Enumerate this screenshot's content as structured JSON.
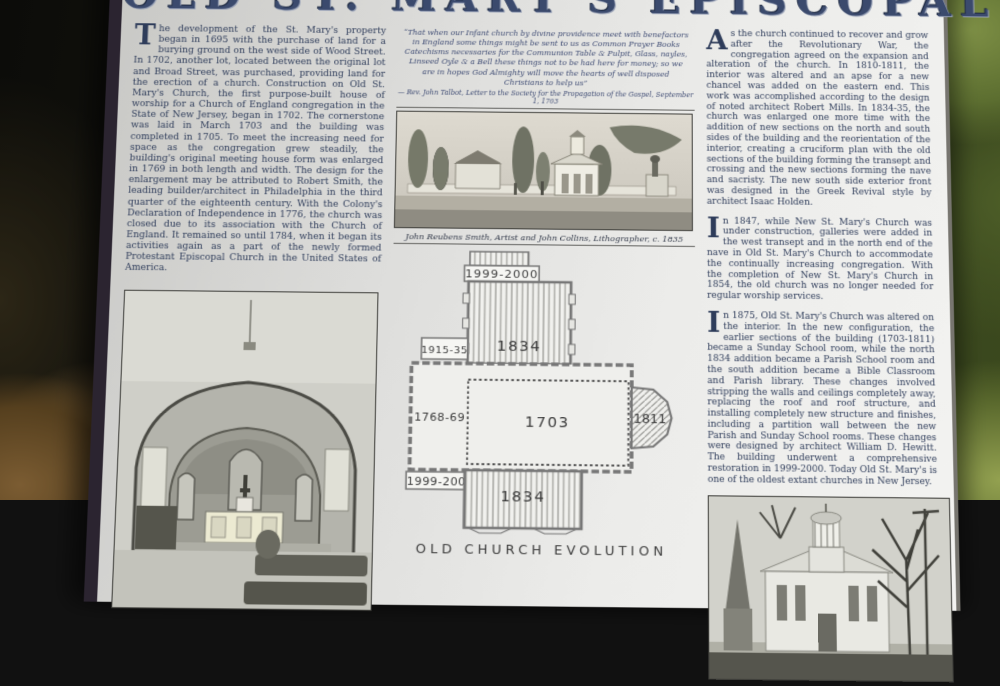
{
  "sign": {
    "title": "OLD ST. MARY'S EPISCOPAL CHURCH",
    "left_column": {
      "paragraph": "The development of the St. Mary's property began in 1695 with the purchase of land for a burying ground on the west side of Wood Street. In 1702, another lot, located between the original lot and Broad Street, was purchased, providing land for the erection of a church. Construction on Old St. Mary's Church, the first purpose-built house of worship for a Church of England congregation in the State of New Jersey, began in 1702. The cornerstone was laid in March 1703 and the building was completed in 1705. To meet the increasing need for space as the congregation grew steadily, the building's original meeting house form was enlarged in 1769 in both length and width. The design for the enlargement may be attributed to Robert Smith, the leading builder/architect in Philadelphia in the third quarter of the eighteenth century. With the Colony's Declaration of Independence in 1776, the church was closed due to its association with the Church of England. It remained so until 1784, when it began its activities again as a part of the newly formed Protestant Episcopal Church in the United States of America."
    },
    "center_column": {
      "quote": "“That when our Infant church by divine providence meet with benefactors in England some things might be sent to us as Common Prayer Books Catechisms necessaries for the Communion Table & Pulpit, Glass, nayles, Linseed Oyle & a Bell these things not to be had here for money; so we are in hopes God Almighty will move the hearts of well disposed Christians to help us”",
      "quote_attribution": "— Rev. John Talbot, Letter to the Society for the Propagation of the Gospel, September 1, 1703",
      "lithograph_caption": "John Reubens Smith, Artist and John Collins, Lithographer, c. 1835",
      "plan": {
        "caption": "OLD CHURCH EVOLUTION",
        "labels": {
          "north_porch": "1999-2000",
          "north_transept": "1834",
          "west_annex": "1915-35",
          "west_extension": "1768-69",
          "original_church": "1703",
          "east_apse": "1811",
          "south_porch": "1999-2000",
          "south_transept": "1834"
        }
      }
    },
    "right_column": {
      "paragraphs": [
        "As the church continued to recover and grow after the Revolutionary War, the congregation agreed on the expansion and alteration of the church. In 1810-1811, the interior was altered and an apse for a new chancel was added on the eastern end. This work was accomplished according to the design of noted architect Robert Mills. In 1834-35, the church was enlarged one more time with the addition of new sections on the north and south sides of the building and the reorientation of the interior, creating a cruciform plan with the old sections of the building forming the transept and crossing and the new sections forming the nave and sacristy. The new south side exterior front was designed in the Greek Revival style by architect Isaac Holden.",
        "In 1847, while New St. Mary's Church was under construction, galleries were added in the west transept and in the north end of the nave in Old St. Mary's Church to accommodate the continually increasing congregation. With the completion of New St. Mary's Church in 1854, the old church was no longer needed for regular worship services.",
        "In 1875, Old St. Mary's Church was altered on the interior. In the new configuration, the earlier sections of the building (1703-1811) became a Sunday School room, while the north 1834 addition became a Parish School room and the south addition became a Bible Classroom and Parish library. These changes involved stripping the walls and ceilings completely away, replacing the roof and roof structure, and installing completely new structure and finishes, including a partition wall between the new Parish and Sunday School rooms. These changes were designed by architect William D. Hewitt. The building underwent a comprehensive restoration in 1999-2000. Today Old St. Mary's is one of the oldest extant churches in New Jersey."
      ]
    }
  }
}
